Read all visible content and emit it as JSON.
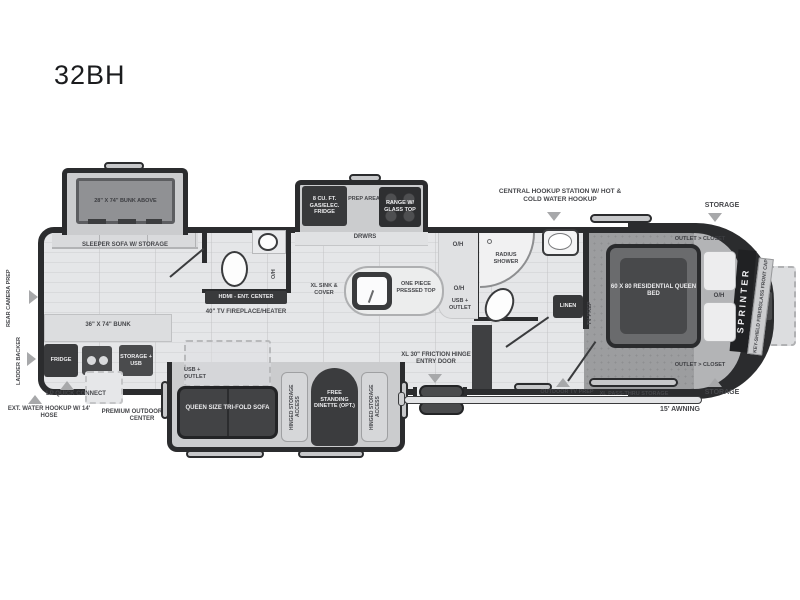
{
  "title": "32BH",
  "labels": {
    "bunk_above": "28\" X 74\" BUNK ABOVE",
    "sleeper_sofa": "SLEEPER SOFA W/ STORAGE",
    "rear_camera_prep": "REAR CAMERA PREP",
    "ladder_backer": "LADDER BACKER",
    "bunk_36": "36\" X 74\" BUNK",
    "fridge": "FRIDGE",
    "storage_usb": "STORAGE + USB",
    "lp_quick_connect": "LP QUICK CONNECT",
    "ext_water_hookup": "EXT. WATER HOOKUP W/ 14' HOSE",
    "premium_outdoor": "PREMIUM OUTDOOR CONV. CENTER",
    "hdmi_ent_center": "HDMI - ENT. CENTER",
    "tv_fireplace": "40\" TV FIREPLACE/HEATER",
    "oh": "O/H",
    "fridge_8cuft": "8 CU. FT. GAS/ELEC. FRIDGE",
    "prep_area": "PREP AREA",
    "range_glass_top": "RANGE W/ GLASS TOP",
    "drwrs": "DRWRS",
    "xl_sink_cover": "XL SINK & COVER",
    "one_piece_top": "ONE PIECE PRESSED TOP",
    "usb_outlet": "USB + OUTLET",
    "central_hookup": "CENTRAL HOOKUP STATION W/ HOT & COLD WATER HOOKUP",
    "radius_shower": "RADIUS SHOWER",
    "linen": "LINEN",
    "tv_prep": "TV PREP",
    "storage": "STORAGE",
    "outlet_closet": "OUTLET > CLOSET",
    "queen_bed": "60 X 80 RESIDENTIAL QUEEN BED",
    "sprinter": "SPRINTER",
    "key_shield": "KEY-SHIELD FIBERGLASS FRONT CAP",
    "entry_door": "XL 30\" FRICTION HINGE ENTRY DOOR",
    "outdoor_tv_prep": "OUTDOOR TV PREP",
    "xl_pass_thru": "XL PASS-THRU STORAGE",
    "awning": "15' AWNING",
    "queen_sofa": "QUEEN SIZE TRI-FOLD SOFA",
    "hinged_storage": "HINGED STORAGE ACCESS",
    "dinette": "FREE STANDING DINETTE (OPT.)"
  },
  "colors": {
    "wall": "#2b2c2e",
    "floor": "#e5e6e8",
    "carpet": "#9c9d9f",
    "slide_fill": "#cbccce",
    "dark_furniture": "#3e3f41",
    "label_text": "#46474b",
    "arrow": "#a7a8aa"
  }
}
